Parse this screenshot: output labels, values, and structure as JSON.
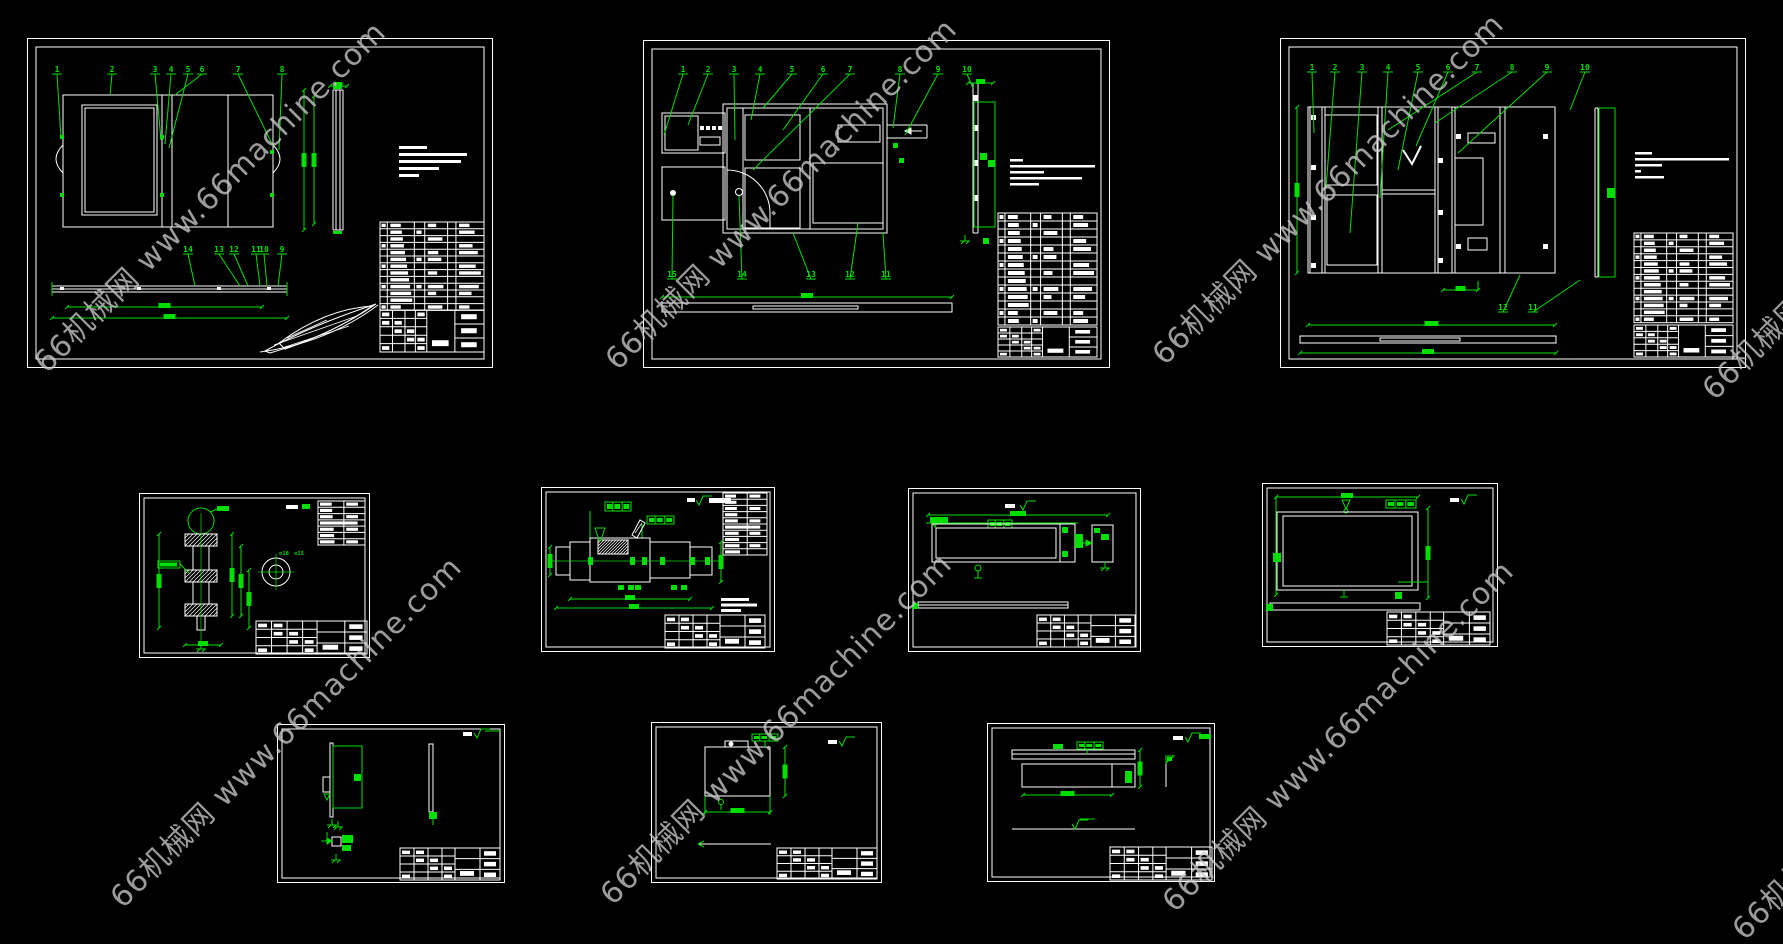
{
  "canvas": {
    "background": "#000000",
    "line_color": "#ffffff",
    "annotation_color": "#00df00"
  },
  "watermark": {
    "text": "66机械网 www.66machine.com",
    "color": "rgba(200,200,200,0.78)"
  },
  "sheets": {
    "assembly1": {
      "label": "assembly-drawing-1",
      "callouts_top": [
        "1",
        "2",
        "3",
        "4",
        "5",
        "6",
        "7",
        "8"
      ],
      "callouts_bottom": [
        "14",
        "13",
        "12",
        "11",
        "10",
        "9"
      ]
    },
    "assembly2": {
      "label": "assembly-drawing-2",
      "callouts_top": [
        "1",
        "2",
        "3",
        "4",
        "5",
        "6",
        "7",
        "8",
        "9",
        "10"
      ],
      "callouts_bottom": [
        "15",
        "14",
        "13",
        "12",
        "11"
      ]
    },
    "assembly3": {
      "label": "assembly-drawing-3",
      "callouts_top": [
        "1",
        "2",
        "3",
        "4",
        "5",
        "6",
        "7",
        "8",
        "9",
        "10"
      ],
      "callouts_bottom": [
        "12",
        "11"
      ]
    },
    "wheel": {
      "label": "part-drawing-wheel",
      "labels": [
        "∅18",
        "∅15"
      ]
    },
    "shaft": {
      "label": "part-drawing-shaft"
    },
    "plate": {
      "label": "part-drawing-plate"
    },
    "frame": {
      "label": "part-drawing-frame"
    },
    "bracket": {
      "label": "part-drawing-bracket"
    },
    "panel": {
      "label": "part-drawing-panel"
    },
    "profile": {
      "label": "part-drawing-profile"
    }
  }
}
